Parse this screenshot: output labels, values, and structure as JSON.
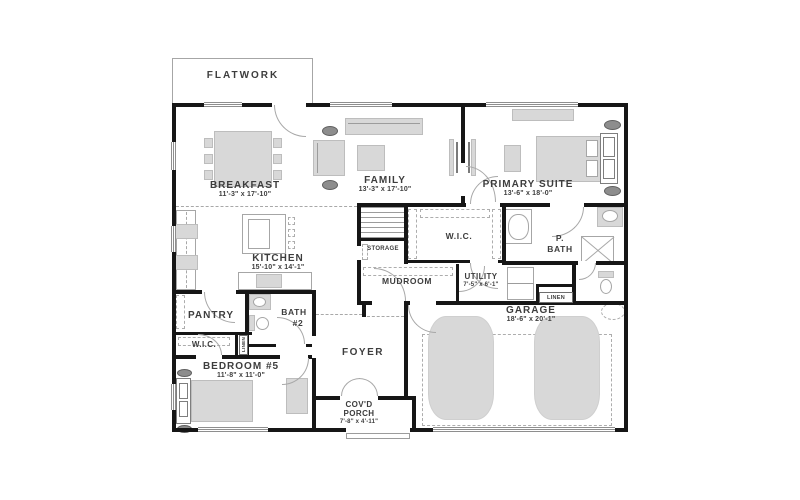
{
  "colors": {
    "wall": "#161616",
    "furniture": "#d8d8d8",
    "accent_dark": "#8d8d8d",
    "text": "#3d3d3d",
    "line": "#a6a6a6"
  },
  "rooms": {
    "flatwork": {
      "label": "FLATWORK"
    },
    "breakfast": {
      "label": "BREAKFAST",
      "dims": "11'-3\" x 17'-10\""
    },
    "family": {
      "label": "FAMILY",
      "dims": "13'-3\" x 17'-10\""
    },
    "primary_suite": {
      "label": "PRIMARY SUITE",
      "dims": "13'-6\" x 18'-0\""
    },
    "kitchen": {
      "label": "KITCHEN",
      "dims": "15'-10\" x 14'-1\""
    },
    "storage": {
      "label": "STORAGE"
    },
    "wic_primary": {
      "label": "W.I.C."
    },
    "p_bath": {
      "line1": "P.",
      "line2": "BATH"
    },
    "mudroom": {
      "label": "MUDROOM"
    },
    "utility": {
      "label": "UTILITY",
      "dims": "7'-5\" x 6'-1\""
    },
    "linen_hall": {
      "label": "LINEN"
    },
    "garage": {
      "label": "GARAGE",
      "dims": "18'-6\" x 20'-1\""
    },
    "pantry": {
      "label": "PANTRY"
    },
    "bath2": {
      "line1": "BATH",
      "line2": "#2"
    },
    "wic_bedroom5": {
      "label": "W.I.C."
    },
    "linen_bedroom5": {
      "label": "LINEN"
    },
    "bedroom5": {
      "label": "BEDROOM #5",
      "dims": "11'-8\" x 11'-0\""
    },
    "foyer": {
      "label": "FOYER"
    },
    "covd_porch": {
      "line1": "COV'D",
      "line2": "PORCH",
      "dims": "7'-8\" x 4'-11\""
    }
  }
}
